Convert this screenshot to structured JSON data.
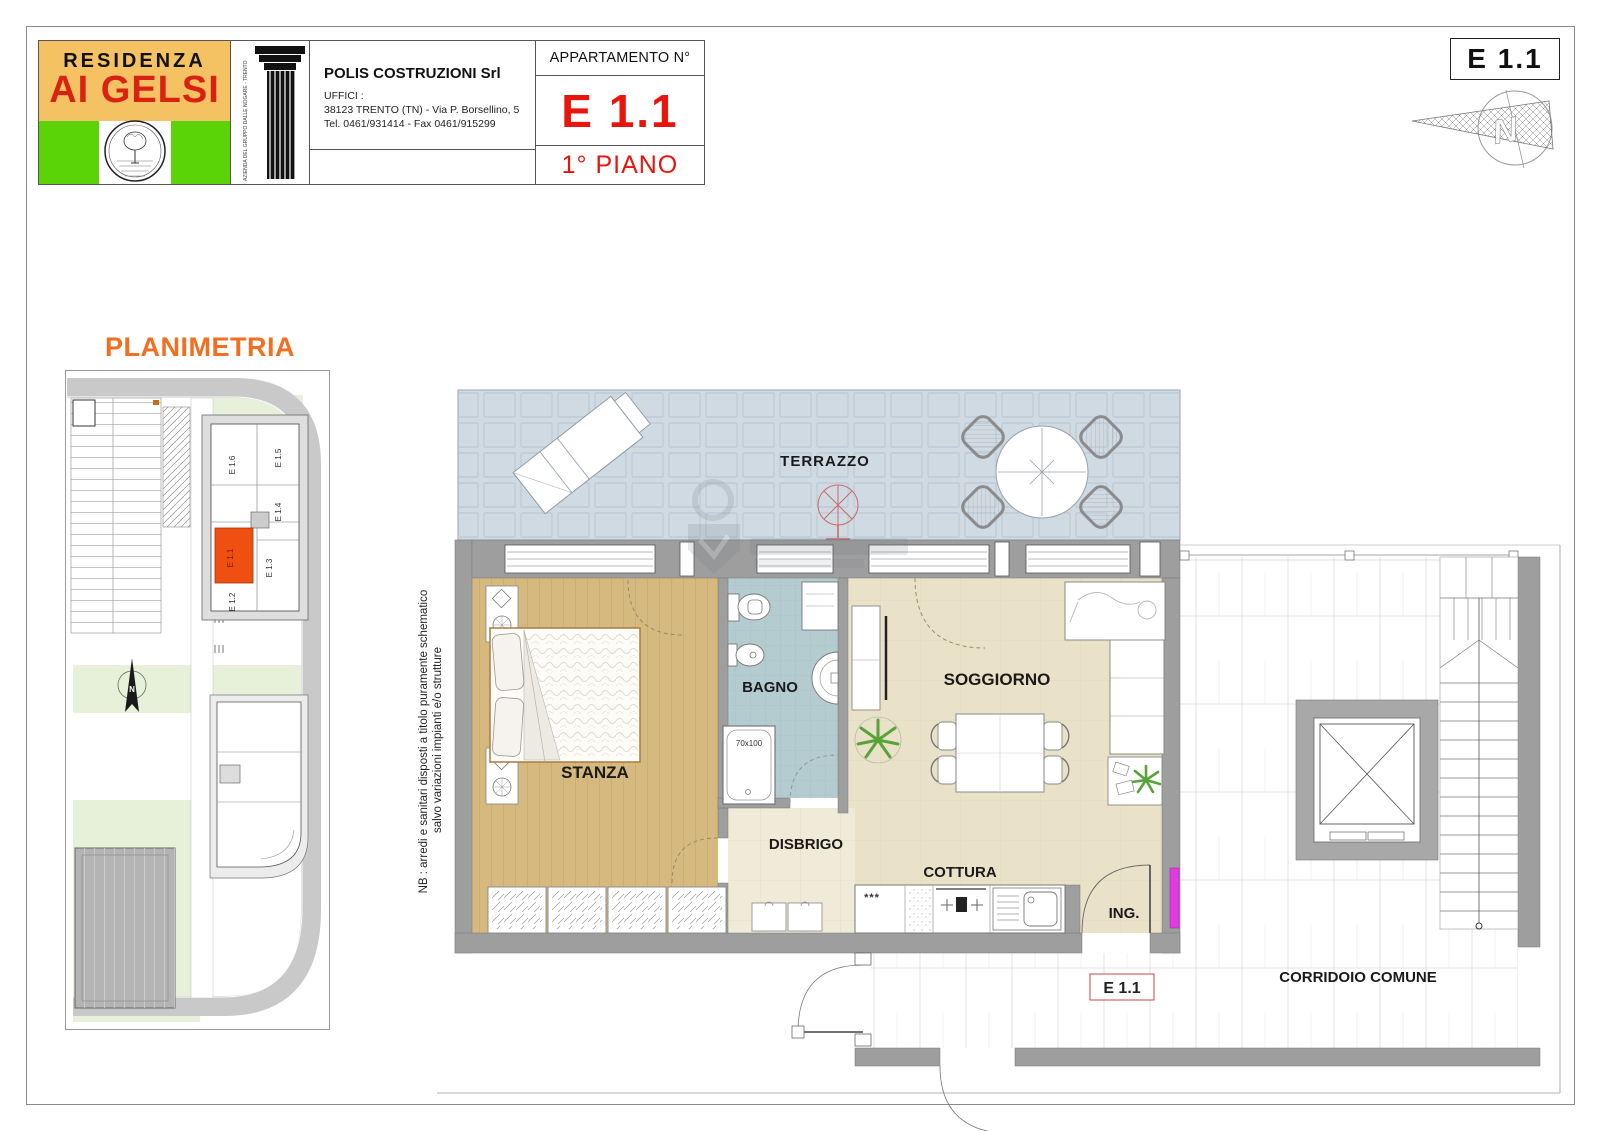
{
  "header": {
    "logo": {
      "line1": "RESIDENZA",
      "line2": "AI GELSI"
    },
    "column_side_text": "AZIENDA DEL GRUPPO DALLE NOGARE - TRENTO",
    "company": {
      "name": "POLIS COSTRUZIONI Srl",
      "offices_label": "UFFICI :",
      "address": "38123 TRENTO (TN) - Via P. Borsellino, 5",
      "phone": "Tel. 0461/931414 - Fax 0461/915299"
    },
    "apartment": {
      "label": "APPARTAMENTO N°",
      "number": "E 1.1",
      "floor": "1° PIANO"
    }
  },
  "stamp": {
    "unit": "E 1.1"
  },
  "site_plan": {
    "title": "PLANIMETRIA",
    "units": [
      "E 1.1",
      "E 1.2",
      "E 1.3",
      "E 1.4",
      "E 1.5",
      "E 1.6"
    ],
    "highlighted_unit": "E 1.1",
    "north_label": "N"
  },
  "floor_plan": {
    "rooms": {
      "terrace": "TERRAZZO",
      "bedroom": "STANZA",
      "bathroom": "BAGNO",
      "living": "SOGGIORNO",
      "hallway": "DISBRIGO",
      "kitchen": "COTTURA",
      "entrance": "ING.",
      "corridor": "CORRIDOIO COMUNE"
    },
    "unit_tag": "E 1.1",
    "shower_size": "70x100",
    "fridge_marks": "***",
    "note_line1": "NB : arredi e sanitari disposti a titolo puramente schematico",
    "note_line2": "salvo variazioni impianti e/o strutture"
  },
  "colors": {
    "terrace_floor": "#cfdae3",
    "bedroom_floor": "#d5b97e",
    "bath_floor": "#b4cbd0",
    "living_floor": "#eae2c8",
    "hall_floor": "#f0ead8",
    "wall_gray": "#9e9e9e",
    "unit_highlight": "#f04f12",
    "accent_red": "#e8150d",
    "accent_orange": "#f26f22",
    "logo_tan": "#f4c263",
    "logo_green": "#5ad406",
    "magenta": "#e23ae2",
    "plant_green": "#57a33a"
  }
}
